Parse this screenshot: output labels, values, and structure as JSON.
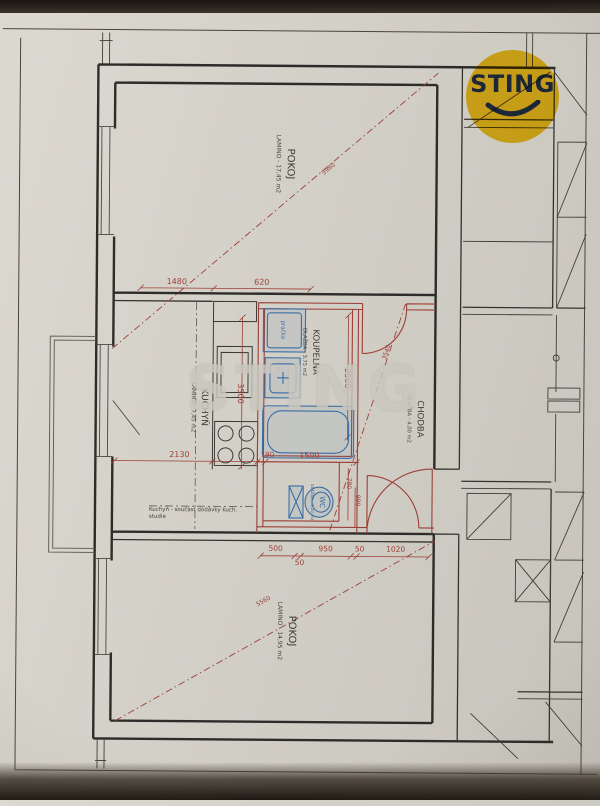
{
  "logo": {
    "text": "STING"
  },
  "watermark": {
    "text": "STING"
  },
  "rooms": {
    "pokoj_top": {
      "name": "POKOJ",
      "area": "LAMINO - 17,45 m2"
    },
    "kuchyn": {
      "name": "KUCHYŇ",
      "area": "LAMINO - 7,45 m2"
    },
    "koupelna": {
      "name": "KOUPELNA",
      "area": "DLAŽBA - 3,75 m2"
    },
    "chodba": {
      "name": "CHODBA",
      "area": "DLAŽBA - 4,00 m2"
    },
    "wc": {
      "name": "WC",
      "area": "DLAŽBA - 1,20 m2"
    },
    "pokoj_bottom": {
      "name": "POKOJ",
      "area": "LAMINO - 14,95 m2"
    }
  },
  "fixtures": {
    "washer": "pračka"
  },
  "note": {
    "line1": "Kuchyň - součást dodávky kuch.",
    "line2": "studie"
  },
  "dims": {
    "top": [
      "1480",
      "620"
    ],
    "v1": "3500",
    "v2": "2500",
    "mid": [
      "2130",
      "190",
      "1500"
    ],
    "wc": [
      "780",
      "990"
    ],
    "bottom": [
      "500",
      "50",
      "950",
      "50",
      "1020"
    ],
    "diag": [
      "5980",
      "3540",
      "5560"
    ]
  },
  "colors": {
    "dimension_red": "#9c3f36",
    "fixture_blue": "#3a6ea5",
    "logo_yellow": "#f6c51d",
    "paper": "#d3d0c8",
    "wall_black": "#2e2c28"
  }
}
